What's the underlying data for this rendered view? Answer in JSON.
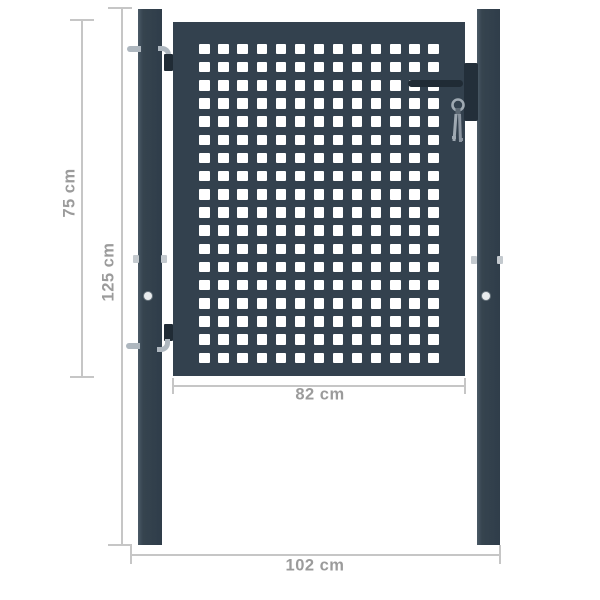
{
  "colors": {
    "background": "#ffffff",
    "anthracite": "#33414e",
    "anthracite_dark": "#202b35",
    "hardware_gray": "#aeb7bf",
    "hole_white": "#ffffff",
    "bolt_light": "#e9ecee",
    "dimension_line": "#c6c6c6",
    "dimension_text": "#9b9b9b"
  },
  "gate": {
    "grid_rows": 18,
    "grid_cols": 13
  },
  "dimensions": {
    "panel_height": {
      "label": "75 cm"
    },
    "post_height": {
      "label": "125 cm"
    },
    "panel_width": {
      "label": "82 cm"
    },
    "total_width": {
      "label": "102 cm"
    }
  }
}
